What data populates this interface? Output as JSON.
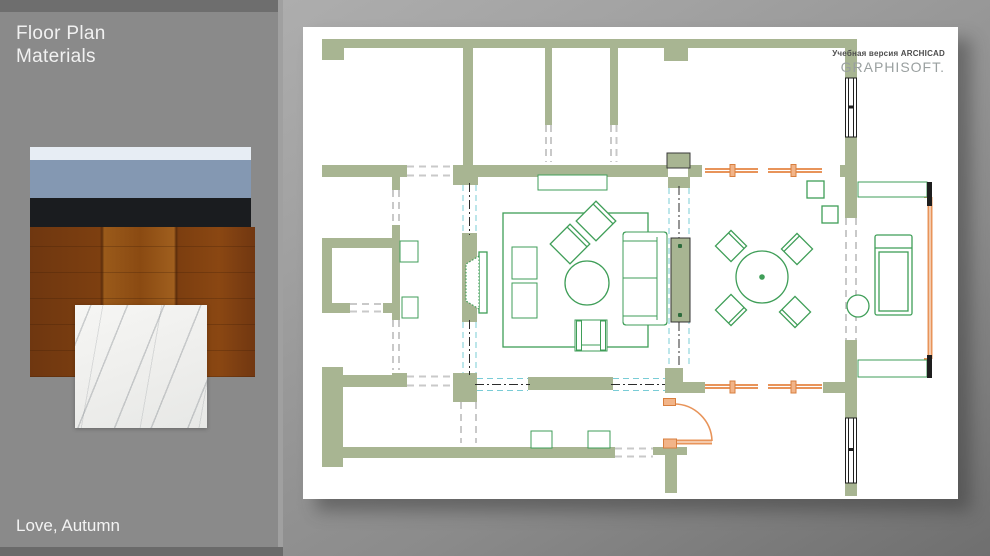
{
  "slide": {
    "title_line1": "Floor Plan",
    "title_line2": "Materials",
    "caption": "Love, Autumn",
    "panel_color": "#8a8a8a",
    "panel_strip_color": "#6e6e6e",
    "background_gradient": [
      "#b5b5b5",
      "#6f6f6f"
    ]
  },
  "materials": [
    {
      "name": "light-blue-laminate",
      "color": "#e7edf4"
    },
    {
      "name": "blue-gray-paint",
      "color": "#8498b2"
    },
    {
      "name": "black-accent",
      "color": "#1a1c1f"
    },
    {
      "name": "wood-plank-floor",
      "color": "#8a4a12"
    },
    {
      "name": "white-marble-tile",
      "color": "#f2f2f0"
    }
  ],
  "floor_plan": {
    "watermark_line1": "Учебная версия ARCHICAD",
    "watermark_line2": "GRAPHISOFT.",
    "paper_color": "#ffffff",
    "wall_color": "#a8b592",
    "furniture_color": "#3f9e58",
    "door_color": "#e8945a",
    "sliding_partition_color": "#79ccd6",
    "window_color": "#1e1e1e"
  }
}
